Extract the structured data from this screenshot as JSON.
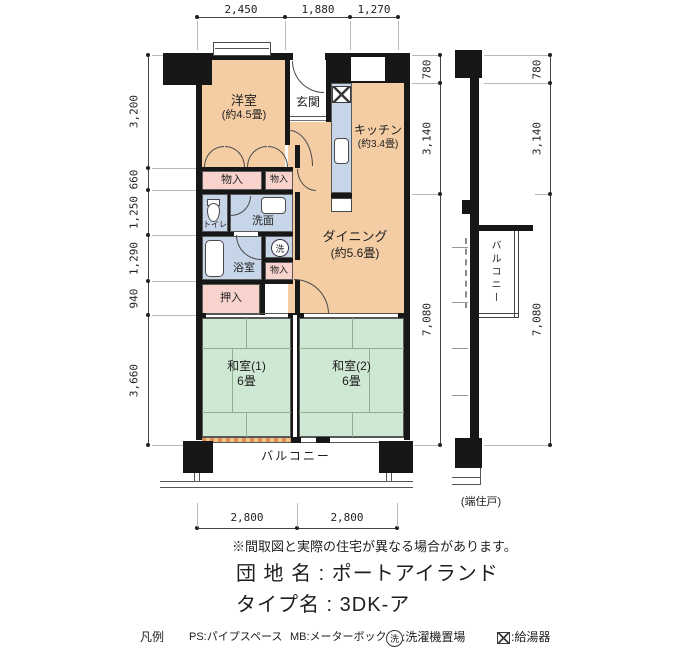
{
  "meta": {
    "note": "※間取図と実際の住宅が異なる場合があります。",
    "estate_line": "団 地 名 : ポートアイランド",
    "type_line": "タイプ名 : 3DK-ア",
    "end_unit_note": "(端住戸)"
  },
  "legend": {
    "heading": "凡例",
    "ps": "PS:パイプスペース",
    "mb": "MB:メーターボックス",
    "wash_symbol": "洗",
    "wash_label": ":洗濯機置場",
    "heater_label": ":給湯器"
  },
  "dims": {
    "top": [
      "2,450",
      "1,880",
      "1,270"
    ],
    "left": [
      "3,200",
      "660",
      "1,250",
      "1,290",
      "940",
      "3,660"
    ],
    "right_inner": [
      "780",
      "3,140",
      "7,080"
    ],
    "right_outer": [
      "780",
      "3,140",
      "7,080"
    ],
    "bottom": [
      "2,800",
      "2,800"
    ]
  },
  "rooms": {
    "yoshitsu": {
      "name": "洋室",
      "size": "(約4.5畳)"
    },
    "genkan": {
      "name": "玄関"
    },
    "kitchen": {
      "name": "キッチン",
      "size": "(約3.4畳)"
    },
    "dining": {
      "name": "ダイニング",
      "size": "(約5.6畳)"
    },
    "closet1": {
      "name": "物入"
    },
    "closet2": {
      "name": "物入"
    },
    "closet3": {
      "name": "物入"
    },
    "toilet": {
      "name": "トイレ"
    },
    "washroom": {
      "name": "洗面"
    },
    "laundry_symbol": "洗",
    "bath": {
      "name": "浴室"
    },
    "oshiire": {
      "name": "押入"
    },
    "washitsu1": {
      "name": "和室(1)",
      "size": "6畳"
    },
    "washitsu2": {
      "name": "和室(2)",
      "size": "6畳"
    },
    "balcony": {
      "name": "バルコニー"
    },
    "side_balcony": {
      "name": "バルコニー"
    }
  },
  "colors": {
    "room_peach": "#f5cda4",
    "closet_pink": "#f8d3ce",
    "wet_blue": "#c6d6e8",
    "tatami_green": "#cfe8d4",
    "wall_black": "#171717"
  }
}
